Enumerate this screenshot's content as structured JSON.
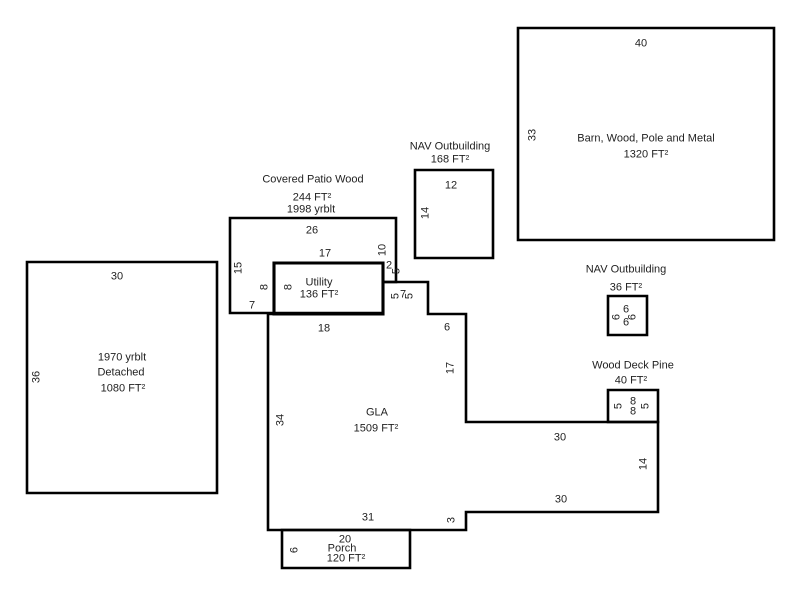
{
  "colors": {
    "line": "#000000",
    "text": "#1f1f1f",
    "background": "#ffffff"
  },
  "sketch": {
    "barn": {
      "title": "Barn, Wood, Pole and Metal",
      "area": "1320 FT²",
      "dim_top": "40",
      "dim_left": "33"
    },
    "nav_outbuilding_large": {
      "title": "NAV Outbuilding",
      "area": "168 FT²",
      "dim_top": "12",
      "dim_left": "14"
    },
    "covered_patio": {
      "title": "Covered Patio Wood",
      "area": "244 FT²",
      "year_built": "1998 yrblt",
      "dim_top": "26",
      "dim_left": "15",
      "dim_right": "10",
      "dim_notch_h": "2",
      "dim_notch_v": "5",
      "dim_bottom": "7"
    },
    "utility": {
      "title": "Utility",
      "area": "136 FT²",
      "dim_top": "17",
      "dim_left_outer": "8",
      "dim_left_inner": "8"
    },
    "detached": {
      "year_built": "1970 yrblt",
      "title": "Detached",
      "area": "1080 FT²",
      "dim_top": "30",
      "dim_left": "36"
    },
    "gla": {
      "title": "GLA",
      "area": "1509 FT²",
      "dim_top": "18",
      "bump_left": "5",
      "bump_top": "7",
      "bump_right": "5",
      "dim_top_right": "6",
      "dim_upper_right": "17",
      "dim_mid_right": "30",
      "dim_right": "14",
      "dim_lower_right": "30",
      "dim_step": "3",
      "dim_bottom": "31",
      "dim_left": "34"
    },
    "nav_outbuilding_small": {
      "title": "NAV Outbuilding",
      "area": "36 FT²",
      "dim_top": "6",
      "dim_left": "6",
      "dim_right": "6",
      "dim_bottom": "6"
    },
    "wood_deck": {
      "title": "Wood Deck Pine",
      "area": "40 FT²",
      "dim_left": "5",
      "dim_top": "8",
      "dim_bottom": "8",
      "dim_right": "5"
    },
    "porch": {
      "title": "Porch",
      "area": "120 FT²",
      "dim_top": "20",
      "dim_left": "6"
    }
  }
}
